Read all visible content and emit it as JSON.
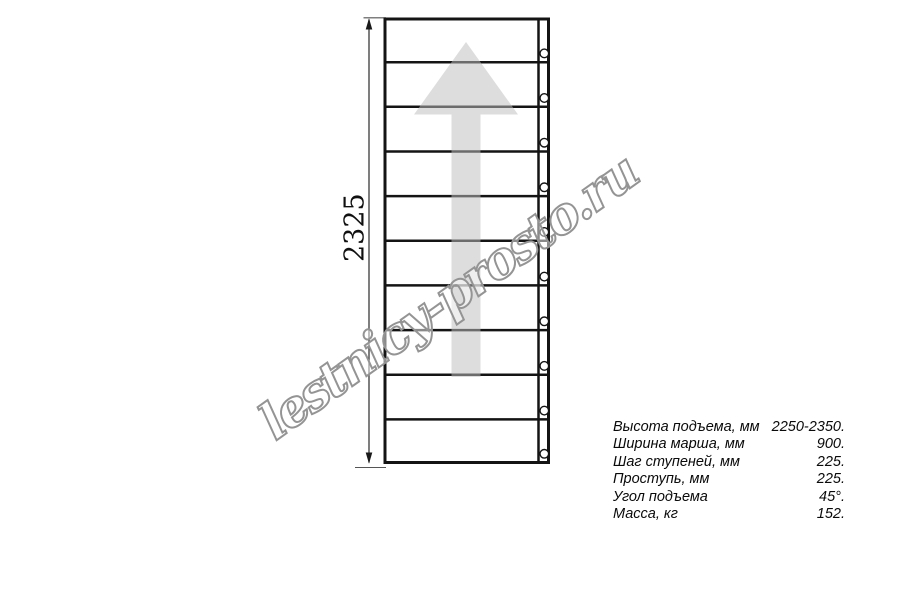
{
  "drawing": {
    "type": "staircase-plan-top-view",
    "dimension_label": "2325",
    "steps_count": 10,
    "bolt_holes_count": 10
  },
  "watermark": {
    "text": "lestnicy-prosto.ru"
  },
  "spec_table": {
    "rows": [
      {
        "label": "Высота подъема, мм",
        "value": "2250-2350."
      },
      {
        "label": "Ширина марша, мм",
        "value": "900."
      },
      {
        "label": "Шаг ступеней, мм",
        "value": "225."
      },
      {
        "label": "Проступь, мм",
        "value": "225."
      },
      {
        "label": "Угол подъема",
        "value": "45°."
      },
      {
        "label": "Масса, кг",
        "value": "152."
      }
    ]
  },
  "icons": {
    "up_arrow": "direction-of-ascent"
  },
  "colors": {
    "background": "#ffffff",
    "line": "#141414",
    "dimension_line": "#3a3a3a",
    "arrow_fill": "rgba(190,190,190,0.52)",
    "watermark_stroke": "#949494",
    "watermark_fill": "rgba(255,255,255,0.5)"
  }
}
